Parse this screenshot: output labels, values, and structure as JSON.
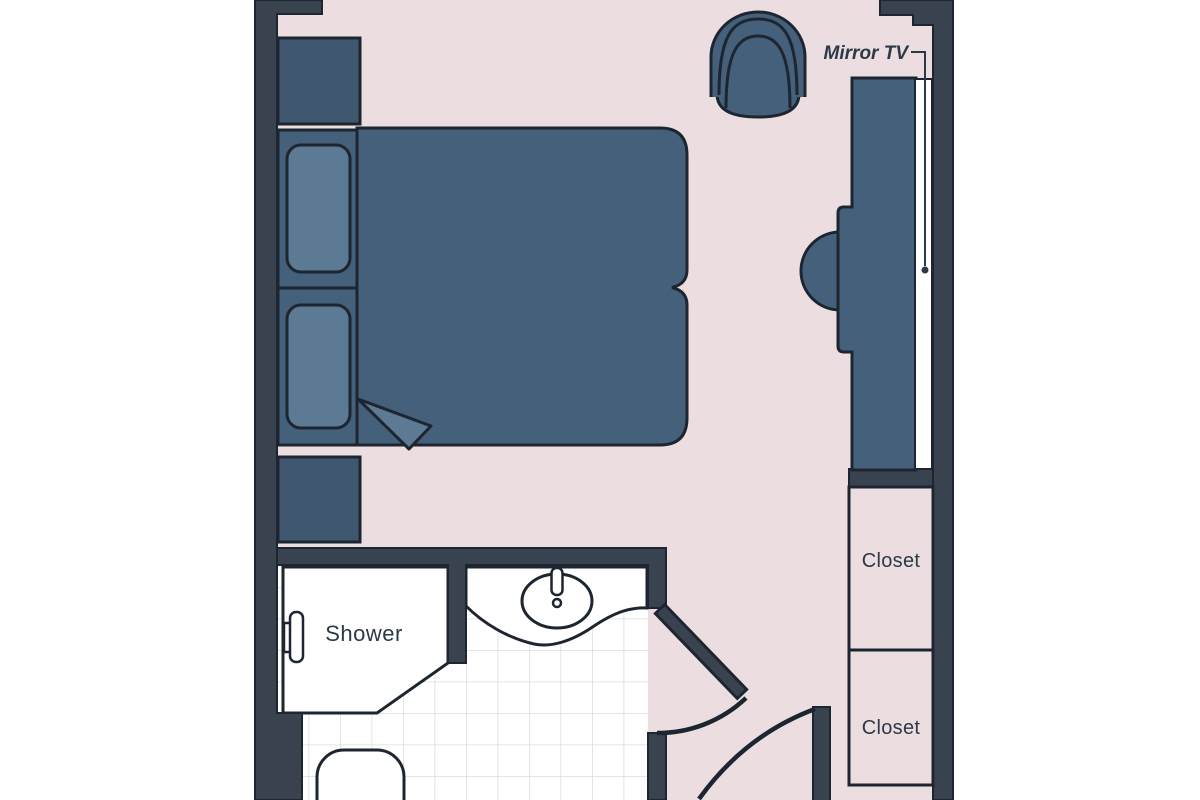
{
  "labels": {
    "shower": "Shower",
    "closet_top": "Closet",
    "closet_bottom": "Closet",
    "mirror_tv": "Mirror TV"
  },
  "colors": {
    "background": "#ffffff",
    "floor": "#ecdee0",
    "wall": "#39434f",
    "outline": "#1d2630",
    "furniture": "#45607a",
    "furniture_dark": "#40586f",
    "furniture_light": "#5c7a94",
    "fixture": "#ffffff",
    "tile_line": "#d9dcde",
    "text": "#2c3947"
  }
}
